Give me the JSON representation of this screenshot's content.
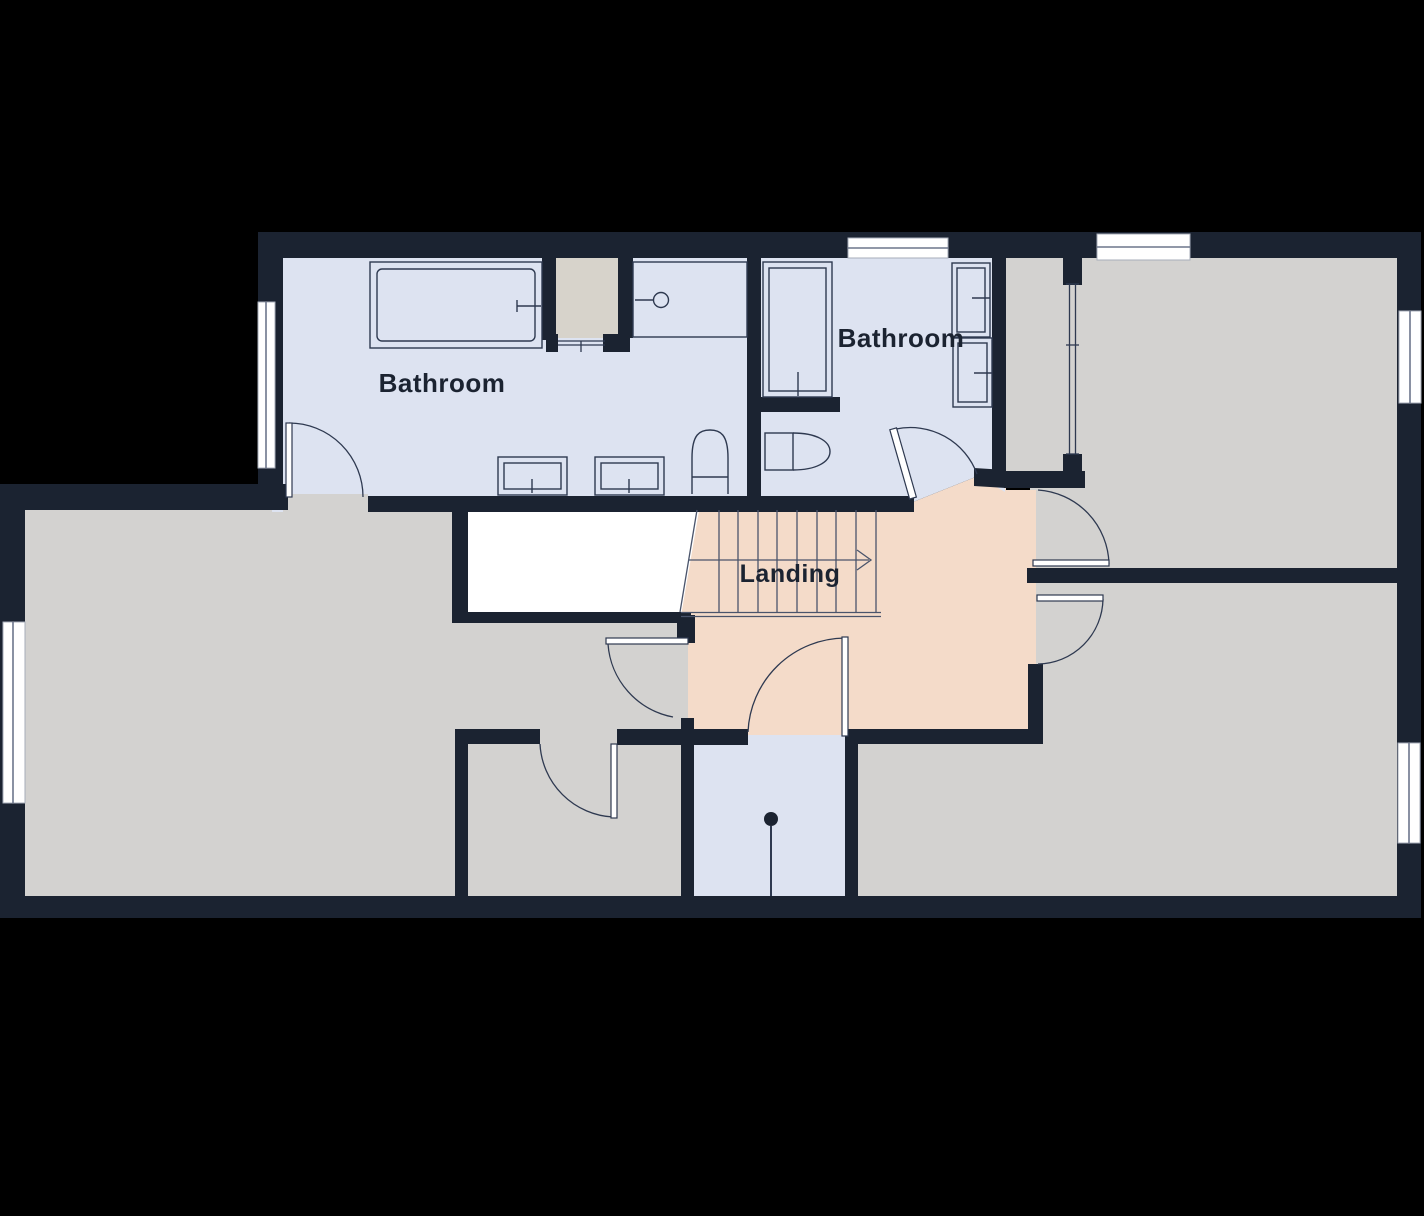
{
  "plan": {
    "kind": "floor-plan"
  },
  "labels": {
    "bathroom_left": "Bathroom",
    "bathroom_right": "Bathroom",
    "landing": "Landing"
  },
  "colors": {
    "background": "#000000",
    "wall": "#1b2331",
    "room-blue": "#dde3f1",
    "room-gray": "#d3d2d0",
    "room-peach": "#f4dbc9",
    "alcove-gray": "#d7d3cb",
    "window-white": "#ffffff",
    "fixture-line": "#2e3950",
    "stair-line": "#4a546b",
    "text": "#1b2331"
  },
  "icons": {
    "stairs_direction": "arrow-right-icon",
    "ceiling_light": "pendant-light-icon"
  }
}
